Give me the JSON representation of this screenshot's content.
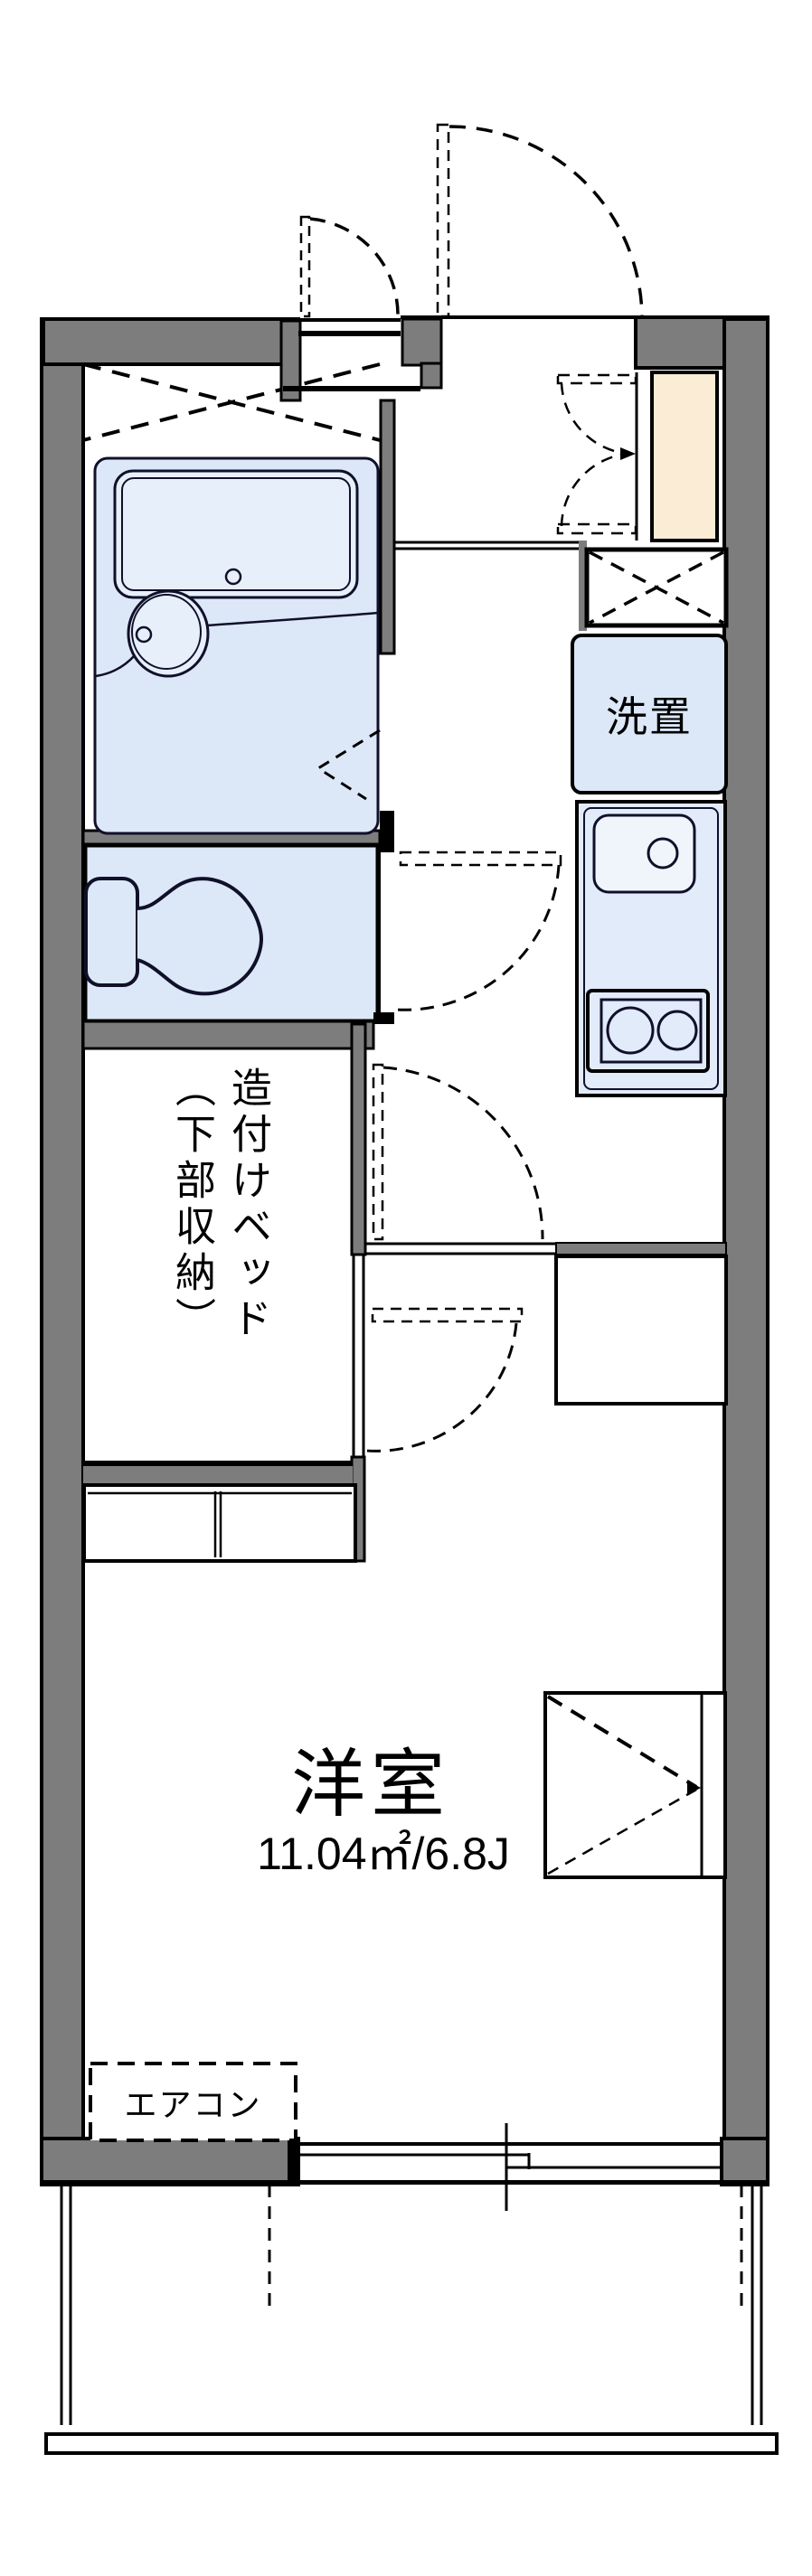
{
  "labels": {
    "laundry": "洗置",
    "bed_line1": "造付けベッド",
    "bed_line2": "（下部収納）",
    "room_name": "洋室",
    "room_area": "11.04㎡/6.8J",
    "aircon": "エアコン"
  },
  "colors": {
    "wall_gray": "#7d7d7d",
    "room_blue": "#dce8f7",
    "fixture_blue": "#e7effa",
    "cabinet_cream": "#fbecd5",
    "line_black": "#000000",
    "fixture_line": "#10102a"
  }
}
